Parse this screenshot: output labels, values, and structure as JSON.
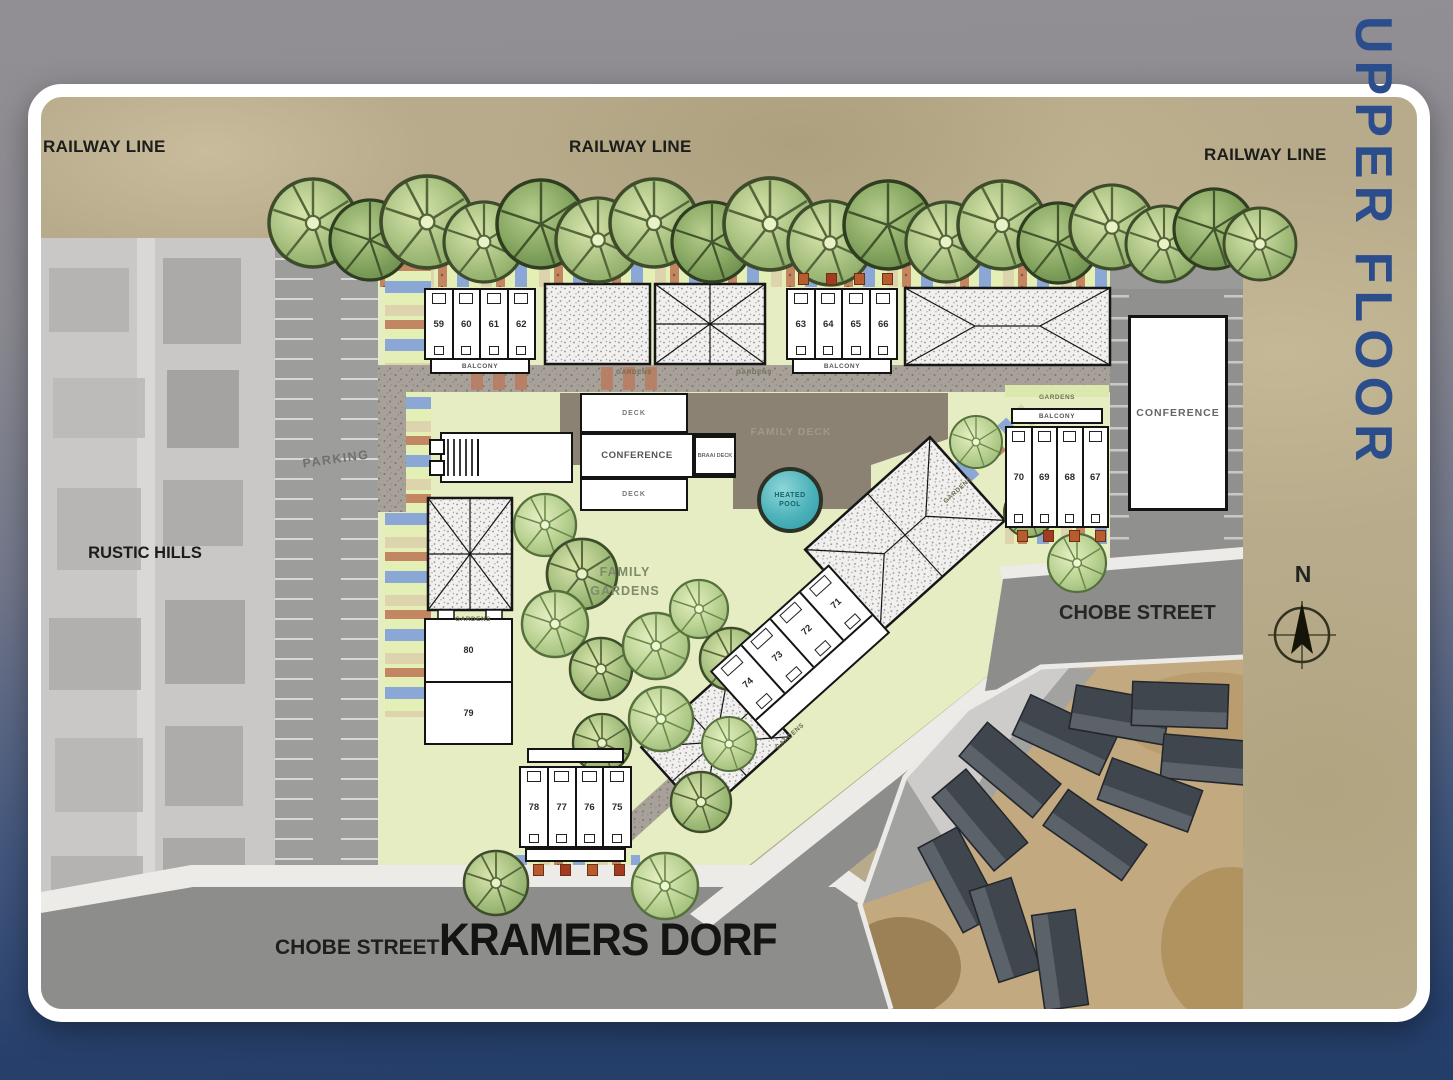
{
  "page": {
    "side_label": "UPPER FLOOR",
    "accent_blue": "#2b4d8c"
  },
  "plan": {
    "labels": {
      "railway": "RAILWAY LINE",
      "rustic_hills": "RUSTIC HILLS",
      "parking": "PARKING",
      "family_line1": "FAMILY",
      "family_line2": "GARDENS",
      "family_deck": "FAMILY DECK",
      "pool_line1": "HEATED",
      "pool_line2": "POOL",
      "conference": "CONFERENCE",
      "braai_deck": "BRAAI DECK",
      "deck": "DECK",
      "balcony": "BALCONY",
      "gardens": "GARDENS",
      "chobe_street": "CHOBE STREET",
      "kramers_dorf": "KRAMERS DORF",
      "compass_n": "N"
    },
    "blocks": {
      "top_left": {
        "units": [
          "59",
          "60",
          "61",
          "62"
        ]
      },
      "top_right": {
        "units": [
          "63",
          "64",
          "65",
          "66"
        ]
      },
      "east": {
        "units": [
          "70",
          "69",
          "68",
          "67"
        ]
      },
      "diagonal": {
        "units": [
          "74",
          "73",
          "72",
          "71"
        ]
      },
      "south": {
        "units": [
          "78",
          "77",
          "76",
          "75"
        ]
      },
      "west": {
        "units": [
          "80",
          "79"
        ]
      }
    },
    "colors": {
      "ground_tan": "#b7ab8b",
      "site_green": "#e6edc3",
      "street_grey": "#8e8e8c",
      "deck_brown": "#8b8274",
      "pool_teal": "#49b4bc"
    }
  }
}
